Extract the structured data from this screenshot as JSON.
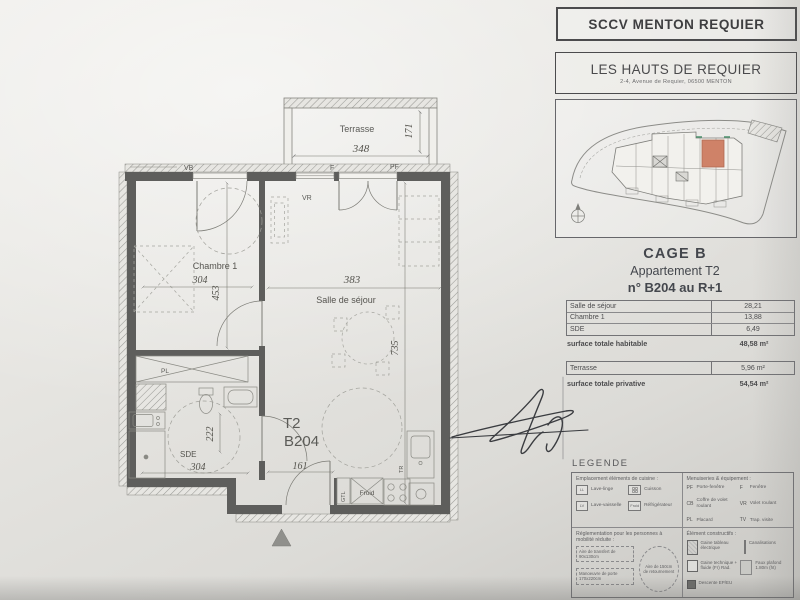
{
  "header": {
    "developer_box": "SCCV MENTON REQUIER",
    "project_title": "LES HAUTS DE REQUIER",
    "project_address": "2-4, Avenue de Requier, 06500 MENTON"
  },
  "unit_block": {
    "cage": "CAGE B",
    "apartment": "Appartement T2",
    "number": "n° B204 au R+1"
  },
  "areas": {
    "rows": [
      {
        "label": "Salle de séjour",
        "value": "28,21"
      },
      {
        "label": "Chambre 1",
        "value": "13,88"
      },
      {
        "label": "SDE",
        "value": "6,49"
      }
    ],
    "habitable_label": "surface totale habitable",
    "habitable_value": "48,58",
    "terrace_label": "Terrasse",
    "terrace_value": "5,96",
    "privative_label": "surface totale privative",
    "privative_value": "54,54",
    "unit": "m²"
  },
  "legend": {
    "title": "LEGENDE",
    "kitchen": {
      "title": "Emplacement éléments de cuisine :",
      "items": [
        {
          "code": "LL",
          "label": "Lave-linge"
        },
        {
          "code": "",
          "label": "Cuisson"
        },
        {
          "code": "LV",
          "label": "Lave-vaisselle"
        },
        {
          "code": "Froid",
          "label": "Réfrigérateur"
        }
      ]
    },
    "joinery": {
      "title": "Menuiseries & équipement :",
      "items": [
        {
          "code": "PF",
          "label": "Porte-fenêtre"
        },
        {
          "code": "F",
          "label": "Fenêtre"
        },
        {
          "code": "CB",
          "label": "Coffre de volet roulant"
        },
        {
          "code": "VR",
          "label": "Volet roulant"
        },
        {
          "code": "PL",
          "label": "Placard"
        },
        {
          "code": "TV",
          "label": "Trap. visite"
        }
      ]
    },
    "pmr": {
      "title": "Réglementation pour les personnes à mobilité réduite :",
      "transfer": "Aire de transfert de 90x130cm",
      "door": "Manoeuvre de porte 170x220cm",
      "circle": "Aire de 150cm de retournement"
    },
    "construction": {
      "title": "Élément constructifs :",
      "items": [
        "Gaine tableau électrique",
        "Canalisations",
        "Gaine technique + fluide (Fr) Rad.",
        "Descente EP/EU",
        "Faux plafond 1.80m (ht)"
      ]
    }
  },
  "plan": {
    "rooms": {
      "terrace": "Terrasse",
      "bedroom": "Chambre 1",
      "living": "Salle de séjour",
      "bathroom": "SDE"
    },
    "unit_line1": "T2",
    "unit_line2": "B204",
    "dims": {
      "terrace_w": "348",
      "terrace_d": "171",
      "bedroom_w": "304",
      "bedroom_h": "453",
      "living_w": "383",
      "living_h": "735",
      "bathroom_w": "304",
      "bathroom_h": "222",
      "hall_w": "161"
    },
    "codes": {
      "vb": "VB",
      "f": "F",
      "pf": "PF",
      "vr": "VR",
      "pl": "PL",
      "gtl": "GTL",
      "froid": "Froid",
      "tr": "TR"
    }
  }
}
